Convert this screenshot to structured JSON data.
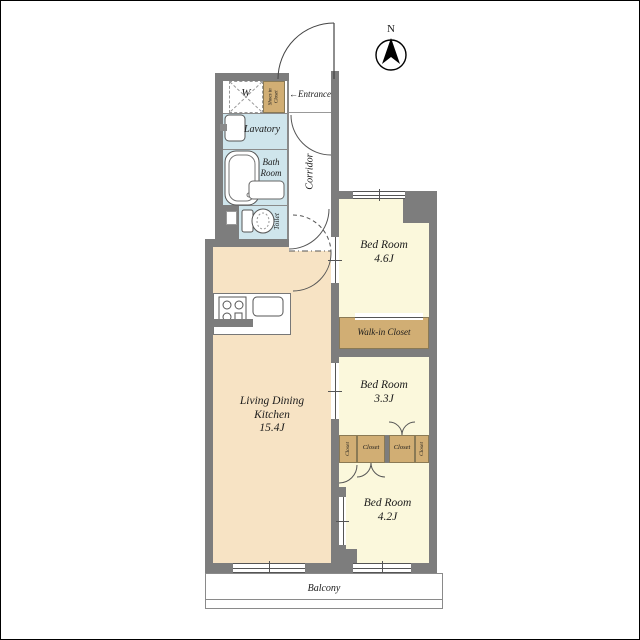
{
  "compass": {
    "north_label": "N"
  },
  "rooms": {
    "w_room": {
      "label": "W"
    },
    "shoes_closet": {
      "label": "Shoes in Closet"
    },
    "entrance": {
      "arrow": "←",
      "label": "Entrance"
    },
    "lavatory": {
      "label": "Lavatory"
    },
    "bath_room": {
      "line1": "Bath",
      "line2": "Room"
    },
    "toilet": {
      "label": "Toilet"
    },
    "corridor": {
      "label": "Corridor"
    },
    "ldk": {
      "line1": "Living Dining",
      "line2": "Kitchen",
      "line3": "15.4J"
    },
    "bedroom_46": {
      "line1": "Bed Room",
      "line2": "4.6J"
    },
    "walk_in_closet": {
      "label": "Walk-in Closet"
    },
    "bedroom_33": {
      "line1": "Bed Room",
      "line2": "3.3J"
    },
    "closet_left_vertical": {
      "label": "Closet"
    },
    "closet_center_left": {
      "label": "Closet"
    },
    "closet_center_right": {
      "label": "Closet"
    },
    "closet_right_vertical": {
      "label": "Closet"
    },
    "bedroom_42": {
      "line1": "Bed Room",
      "line2": "4.2J"
    },
    "balcony": {
      "label": "Balcony"
    }
  },
  "colors": {
    "wall": "#7d7d7d",
    "wet_area": "#cfe5ec",
    "ldk": "#f7e3c4",
    "bedroom": "#fbf8dc",
    "closet": "#d1ae74",
    "outline": "#555555"
  }
}
